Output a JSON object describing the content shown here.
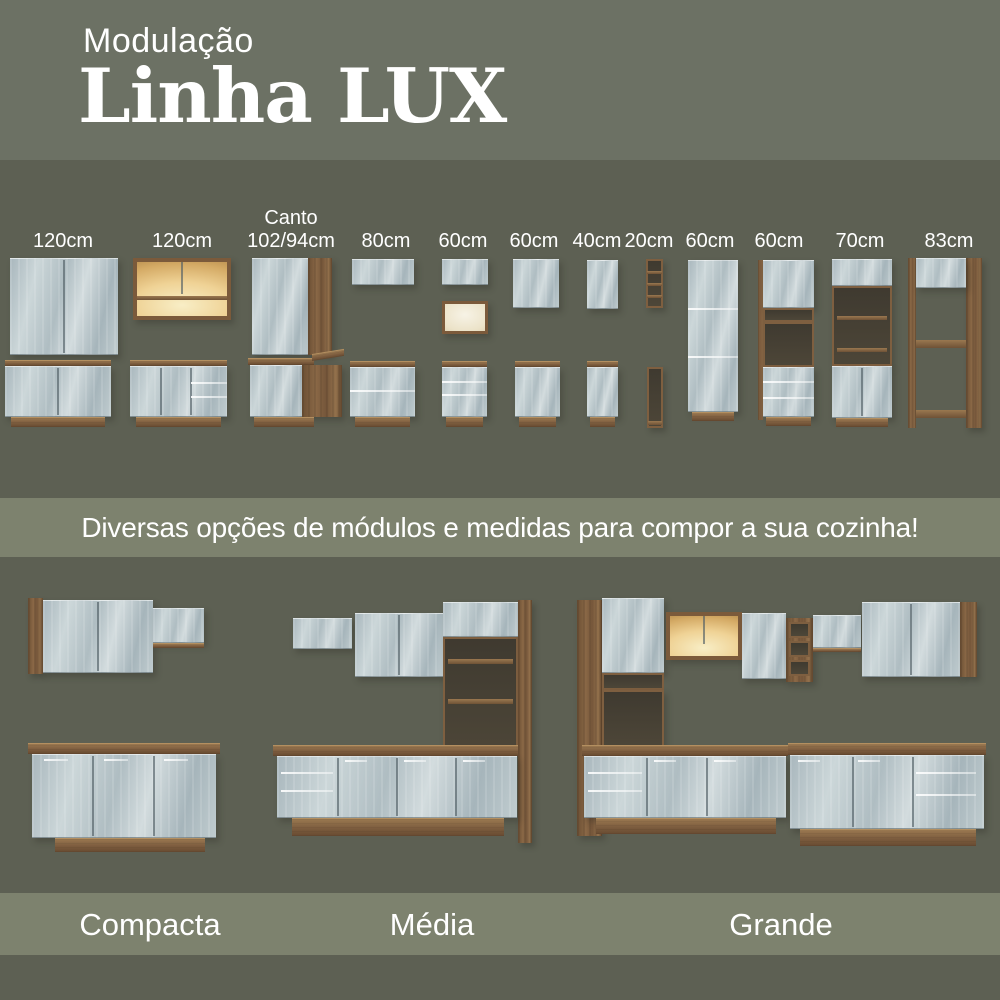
{
  "header": {
    "kicker": "Modulação",
    "title": "Linha LUX"
  },
  "modules": [
    {
      "id": "upper-120",
      "label": "120cm"
    },
    {
      "id": "upper-120-lit",
      "label": "120cm"
    },
    {
      "id": "corner-102-94",
      "label": "Canto",
      "label2": "102/94cm"
    },
    {
      "id": "upper-80",
      "label": "80cm"
    },
    {
      "id": "upper-60-nicho",
      "label": "60cm"
    },
    {
      "id": "upper-60",
      "label": "60cm"
    },
    {
      "id": "upper-40",
      "label": "40cm"
    },
    {
      "id": "shelf-20",
      "label": "20cm"
    },
    {
      "id": "tall-60-pantry",
      "label": "60cm"
    },
    {
      "id": "tall-60-oven",
      "label": "60cm"
    },
    {
      "id": "tall-70",
      "label": "70cm"
    },
    {
      "id": "tall-83-fridge",
      "label": "83cm"
    }
  ],
  "banner": {
    "text": "Diversas opções de módulos e medidas para compor a sua cozinha!"
  },
  "kitchens": [
    {
      "name": "Compacta"
    },
    {
      "name": "Média"
    },
    {
      "name": "Grande"
    }
  ],
  "colors": {
    "background_light": "#6c7164",
    "background_dark": "#5d6053",
    "band": "#7d826e",
    "text": "#ffffff",
    "wood": "#82613f",
    "glass_door": "#bfccd0",
    "lit_interior": "#f2dfa6"
  }
}
